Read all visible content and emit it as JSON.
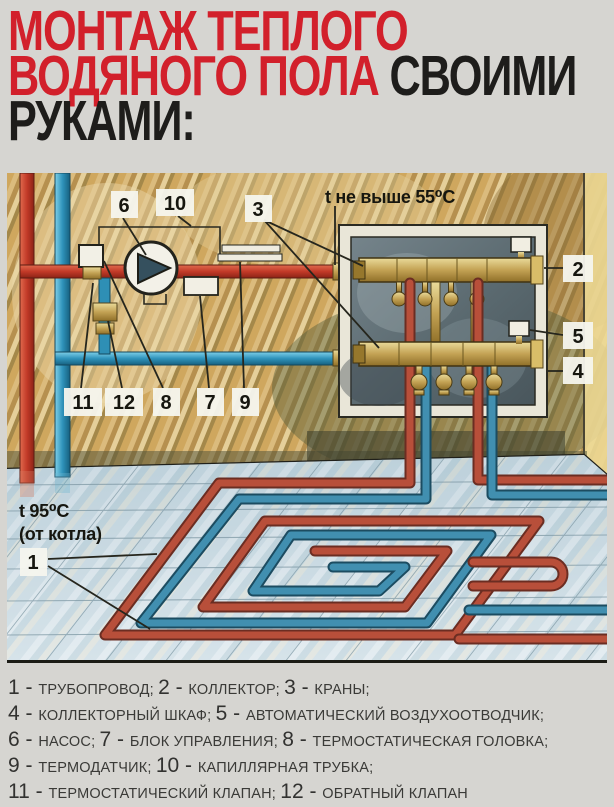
{
  "title": {
    "line1": "МОНТАЖ ТЕПЛОГО",
    "line2_red": "ВОДЯНОГО ПОЛА",
    "line2_black": " СВОИМИ",
    "line3": "РУКАМИ:",
    "accent_red": "#d2202b",
    "text_black": "#1e1d1b"
  },
  "diagram": {
    "callouts": {
      "n1": "1",
      "n2": "2",
      "n3": "3",
      "n4": "4",
      "n5": "5",
      "n6": "6",
      "n7": "7",
      "n8": "8",
      "n9": "9",
      "n10": "10",
      "n11": "11",
      "n12": "12"
    },
    "temp_max_label": "t не выше 55⁰C",
    "temp_supply_label": "t 95⁰C",
    "temp_supply_sub": "(от котла)",
    "colors": {
      "supply_pipe_red": "#b84f3a",
      "return_pipe_blue": "#418fb0",
      "brass": "#c3a254",
      "wall_tan": "#cfa961",
      "floor_tile": "#cddbe3"
    }
  },
  "legend": {
    "lines": [
      [
        {
          "n": "1",
          "t": "ТРУБОПРОВОД;"
        },
        {
          "n": "2",
          "t": "КОЛЛЕКТОР;"
        },
        {
          "n": "3",
          "t": "КРАНЫ;"
        }
      ],
      [
        {
          "n": "4",
          "t": "КОЛЛЕКТОРНЫЙ ШКАФ;"
        },
        {
          "n": "5",
          "t": "АВТОМАТИЧЕСКИЙ ВОЗДУХООТВОДЧИК;"
        }
      ],
      [
        {
          "n": "6",
          "t": "НАСОС;"
        },
        {
          "n": "7",
          "t": "БЛОК УПРАВЛЕНИЯ;"
        },
        {
          "n": "8",
          "t": "ТЕРМОСТАТИЧЕСКАЯ ГОЛОВКА;"
        }
      ],
      [
        {
          "n": "9",
          "t": "ТЕРМОДАТЧИК;"
        },
        {
          "n": "10",
          "t": "КАПИЛЛЯРНАЯ ТРУБКА;"
        }
      ],
      [
        {
          "n": "11",
          "t": "ТЕРМОСТАТИЧЕСКИЙ КЛАПАН;"
        },
        {
          "n": "12",
          "t": "ОБРАТНЫЙ КЛАПАН"
        }
      ]
    ]
  }
}
